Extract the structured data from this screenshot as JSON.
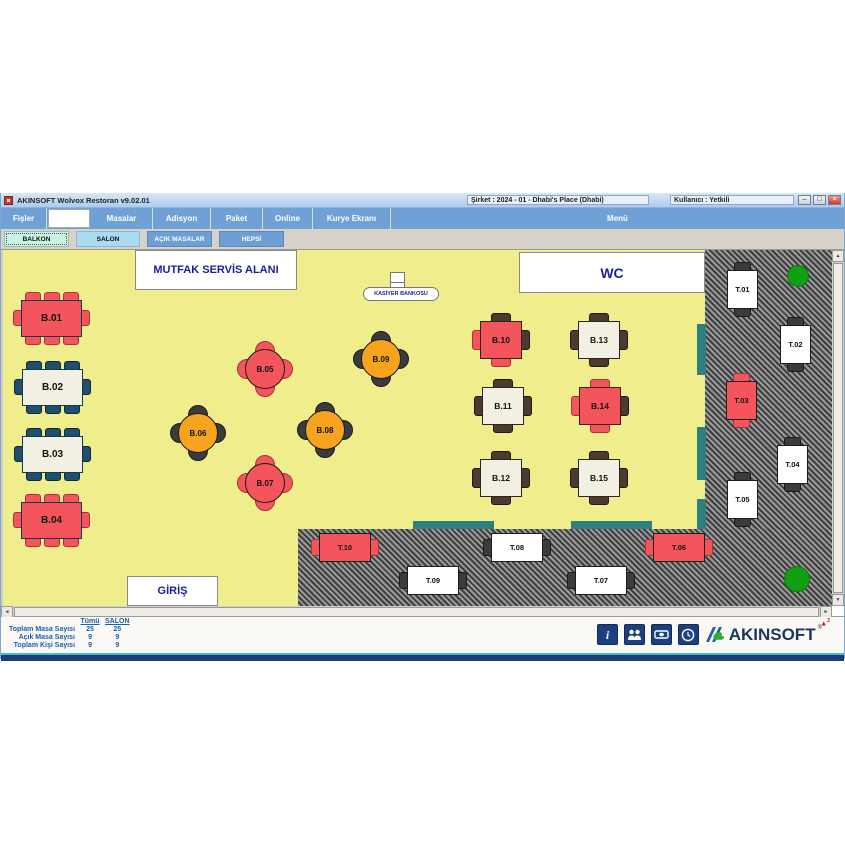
{
  "window": {
    "title": "AKINSOFT Wolvox Restoran v9.02.01",
    "company_label": "Şirket : 2024 - 01 - Dhabi's Place (Dhabi)",
    "user_label": "Kullanıcı : Yetkili"
  },
  "menu": {
    "items": [
      "Fişler",
      "Masalar",
      "Adisyon",
      "Paket",
      "Online",
      "Kurye Ekranı"
    ],
    "right_label": "Menü",
    "search_value": ""
  },
  "tabs": [
    {
      "label": "BALKON",
      "style": "mint"
    },
    {
      "label": "SALON",
      "style": "lblue"
    },
    {
      "label": "AÇIK MASALAR",
      "style": "blue"
    },
    {
      "label": "HEPSİ",
      "style": "blue"
    }
  ],
  "palette": {
    "red": "#F4555C",
    "cream": "#F2EFE3",
    "orange": "#F6A41D",
    "white": "#FFFFFF",
    "navy": "#1F4F6B",
    "dark": "#3B3B3B",
    "brown": "#4A3B2C",
    "teal": "#2E7F80",
    "green": "#12A012",
    "yellow": "#F0EE8C"
  },
  "floor": {
    "zones": [
      {
        "name": "walkway-right-hatch",
        "type": "hatch",
        "x": 702,
        "y": 0,
        "w": "auto",
        "h": 356
      },
      {
        "name": "walkway-bottom-hatch",
        "type": "hatch",
        "x": 295,
        "y": 279,
        "w": "auto",
        "h": 77
      },
      {
        "name": "teal-strip-1",
        "type": "teal",
        "x": 694,
        "y": 74,
        "w": 9,
        "h": 51
      },
      {
        "name": "teal-strip-2",
        "type": "teal",
        "x": 694,
        "y": 177,
        "w": 9,
        "h": 53
      },
      {
        "name": "teal-strip-3",
        "type": "teal",
        "x": 694,
        "y": 249,
        "w": 9,
        "h": 30
      },
      {
        "name": "teal-strip-4",
        "type": "teal",
        "x": 410,
        "y": 271,
        "w": 81,
        "h": 8
      },
      {
        "name": "teal-strip-5",
        "type": "teal",
        "x": 568,
        "y": 271,
        "w": 81,
        "h": 8
      },
      {
        "name": "plant-top-right",
        "type": "green",
        "x": 784,
        "y": 15,
        "w": 22,
        "h": 22
      },
      {
        "name": "plant-bottom-right",
        "type": "green",
        "x": 781,
        "y": 316,
        "w": 26,
        "h": 26
      }
    ],
    "labels": [
      {
        "id": "mutfak",
        "text": "MUTFAK SERVİS ALANI",
        "x": 132,
        "y": 0,
        "w": 162,
        "h": 40,
        "fs": 11
      },
      {
        "id": "wc",
        "text": "WC",
        "x": 516,
        "y": 2,
        "w": 186,
        "h": 41,
        "fs": 14
      },
      {
        "id": "giris",
        "text": "GİRİŞ",
        "x": 124,
        "y": 326,
        "w": 91,
        "h": 30,
        "fs": 11
      },
      {
        "id": "kasiyer",
        "text": "KASİYER BANKOSU",
        "x": 360,
        "y": 37,
        "w": 76,
        "h": 14,
        "fs": 5.5,
        "pill": true
      }
    ],
    "cashier_desk": {
      "x": 387,
      "y": 22,
      "w": 15,
      "h": 20
    },
    "tables": [
      {
        "id": "B.01",
        "kind": "rect8",
        "x": 10,
        "y": 42,
        "color": "red",
        "chair": "red"
      },
      {
        "id": "B.02",
        "kind": "rect8",
        "x": 11,
        "y": 111,
        "color": "cream",
        "chair": "navy"
      },
      {
        "id": "B.03",
        "kind": "rect8",
        "x": 11,
        "y": 178,
        "color": "cream",
        "chair": "navy"
      },
      {
        "id": "B.04",
        "kind": "rect8",
        "x": 10,
        "y": 244,
        "color": "red",
        "chair": "red"
      },
      {
        "id": "B.05",
        "kind": "round4",
        "x": 234,
        "y": 91,
        "color": "red",
        "chair": "red"
      },
      {
        "id": "B.06",
        "kind": "round4",
        "x": 167,
        "y": 155,
        "color": "orange",
        "chair": "dark"
      },
      {
        "id": "B.07",
        "kind": "round4",
        "x": 234,
        "y": 205,
        "color": "red",
        "chair": "red"
      },
      {
        "id": "B.08",
        "kind": "round4",
        "x": 294,
        "y": 152,
        "color": "orange",
        "chair": "dark"
      },
      {
        "id": "B.09",
        "kind": "round4",
        "x": 350,
        "y": 81,
        "color": "orange",
        "chair": "dark"
      },
      {
        "id": "B.10",
        "kind": "square4",
        "x": 469,
        "y": 63,
        "color": "red",
        "chairs": [
          "brown",
          "brown",
          "red",
          "red"
        ]
      },
      {
        "id": "B.13",
        "kind": "square4",
        "x": 567,
        "y": 63,
        "color": "cream",
        "chairs": [
          "brown",
          "brown",
          "brown",
          "brown"
        ]
      },
      {
        "id": "B.11",
        "kind": "square4",
        "x": 471,
        "y": 129,
        "color": "cream",
        "chairs": [
          "brown",
          "brown",
          "brown",
          "brown"
        ]
      },
      {
        "id": "B.14",
        "kind": "square4",
        "x": 568,
        "y": 129,
        "color": "red",
        "chairs": [
          "red",
          "brown",
          "red",
          "red"
        ]
      },
      {
        "id": "B.12",
        "kind": "square4",
        "x": 469,
        "y": 201,
        "color": "cream",
        "chairs": [
          "brown",
          "brown",
          "brown",
          "brown"
        ]
      },
      {
        "id": "B.15",
        "kind": "square4",
        "x": 567,
        "y": 201,
        "color": "cream",
        "chairs": [
          "brown",
          "brown",
          "brown",
          "brown"
        ]
      },
      {
        "id": "T.01",
        "kind": "vrect",
        "x": 724,
        "y": 12,
        "color": "white",
        "chair": "dark"
      },
      {
        "id": "T.02",
        "kind": "vrect",
        "x": 777,
        "y": 67,
        "color": "white",
        "chair": "dark"
      },
      {
        "id": "T.03",
        "kind": "vrect",
        "x": 723,
        "y": 123,
        "color": "red",
        "chair": "red"
      },
      {
        "id": "T.04",
        "kind": "vrect",
        "x": 774,
        "y": 187,
        "color": "white",
        "chair": "dark"
      },
      {
        "id": "T.05",
        "kind": "vrect",
        "x": 724,
        "y": 222,
        "color": "white",
        "chair": "dark"
      },
      {
        "id": "T.10",
        "kind": "hrect",
        "x": 308,
        "y": 283,
        "color": "red",
        "chair": "red"
      },
      {
        "id": "T.08",
        "kind": "hrect",
        "x": 480,
        "y": 283,
        "color": "white",
        "chair": "dark"
      },
      {
        "id": "T.06",
        "kind": "hrect",
        "x": 642,
        "y": 283,
        "color": "red",
        "chair": "red"
      },
      {
        "id": "T.09",
        "kind": "hrect",
        "x": 396,
        "y": 316,
        "color": "white",
        "chair": "dark"
      },
      {
        "id": "T.07",
        "kind": "hrect",
        "x": 564,
        "y": 316,
        "color": "white",
        "chair": "dark"
      }
    ]
  },
  "stats": {
    "columns": [
      "Tümü",
      "SALON"
    ],
    "rows": [
      {
        "label": "Toplam Masa Sayısı",
        "values": [
          "25",
          "25"
        ]
      },
      {
        "label": "Açık Masa Sayısı",
        "values": [
          "9",
          "9"
        ]
      },
      {
        "label": "Toplam Kişi Sayısı",
        "values": [
          "9",
          "9"
        ]
      }
    ]
  },
  "brand": {
    "name": "AKINSOFT",
    "registered": "®",
    "badge_triangle": "▲",
    "badge_count": "2"
  }
}
